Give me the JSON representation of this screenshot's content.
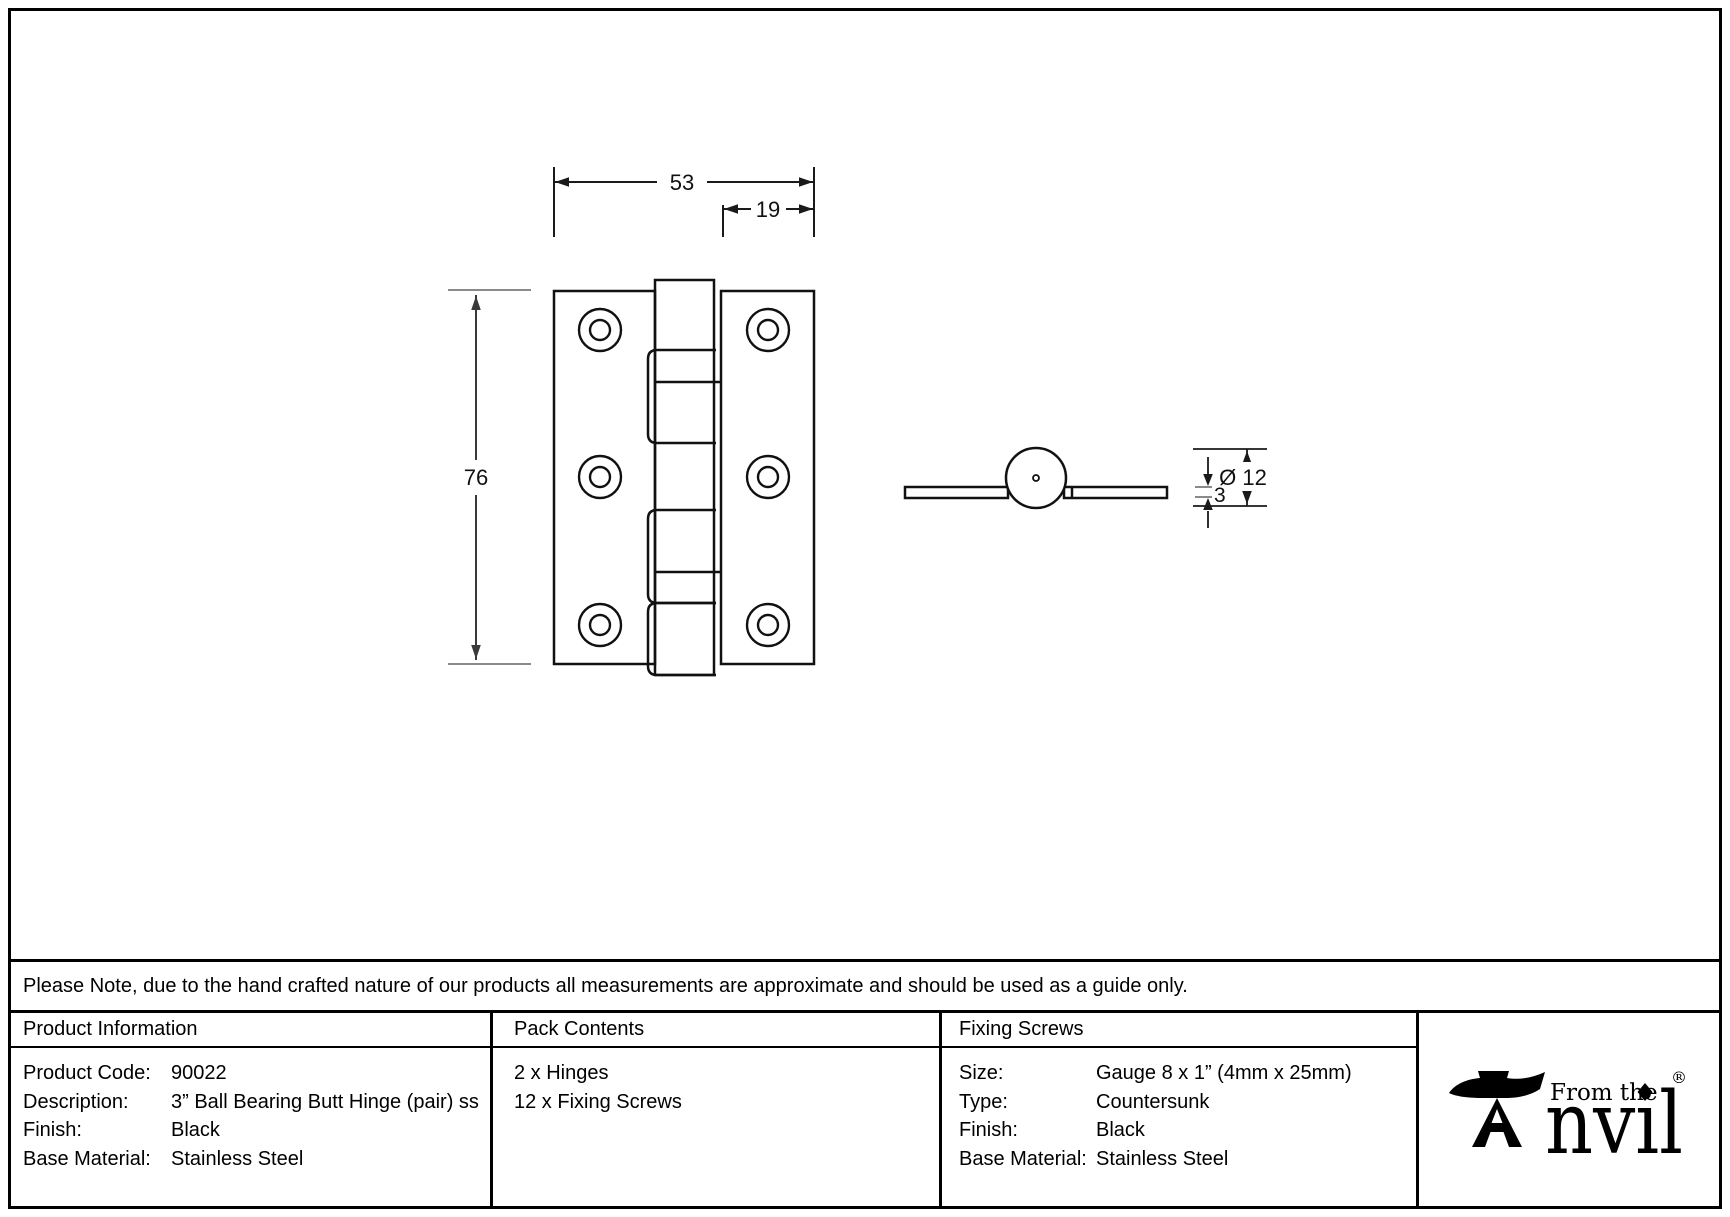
{
  "note": {
    "text": "Please Note, due to the hand crafted nature of our products all measurements are approximate and should be used as a guide only."
  },
  "drawing": {
    "front_view": {
      "dim_width": "53",
      "dim_right_leaf": "19",
      "dim_height": "76"
    },
    "side_view": {
      "dim_diameter": "Ø 12",
      "dim_thickness": "3"
    }
  },
  "table": {
    "product_information": {
      "title": "Product Information",
      "rows": [
        {
          "label": "Product Code:",
          "value": "90022"
        },
        {
          "label": "Description:",
          "value": "3” Ball Bearing Butt Hinge (pair) ss"
        },
        {
          "label": "Finish:",
          "value": "Black"
        },
        {
          "label": "Base Material:",
          "value": "Stainless Steel"
        }
      ]
    },
    "pack_contents": {
      "title": "Pack Contents",
      "items": [
        "2 x Hinges",
        "12 x Fixing Screws"
      ]
    },
    "fixing_screws": {
      "title": "Fixing Screws",
      "rows": [
        {
          "label": "Size:",
          "value": "Gauge 8 x 1” (4mm x 25mm)"
        },
        {
          "label": "Type:",
          "value": "Countersunk"
        },
        {
          "label": "Finish:",
          "value": "Black"
        },
        {
          "label": "Base Material:",
          "value": "Stainless Steel"
        }
      ]
    }
  },
  "logo": {
    "tagline": "From the",
    "brand_rest": "nvil",
    "registered": "®"
  }
}
